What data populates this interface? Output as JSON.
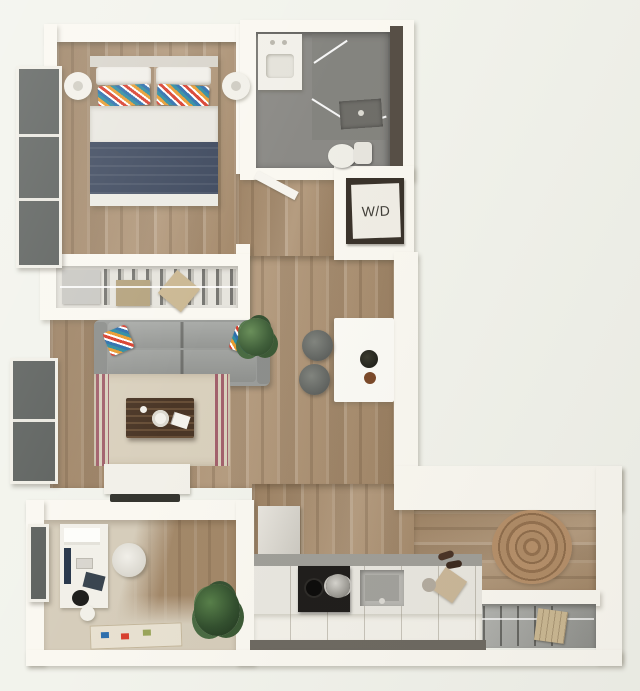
{
  "plan": {
    "wd_label": "W/D"
  },
  "colors": {
    "bg": "#f2f3ec",
    "wall": "#faf8f1",
    "wood": "#ab8f6f",
    "bath_floor": "#8b8a86",
    "sofa": "#9b9d9a",
    "navy": "#3f4a5f",
    "rug": "#d9d0bd",
    "rug_stripe": "#a2616c",
    "den_carpet": "#d6cdbb",
    "entry_rug": "#b08c67",
    "counter": "#e9e7e0",
    "cabinet": "#f3f1ea",
    "stove": "#201e1c",
    "steel": "#b9b8b3",
    "plant": "#41603b",
    "pillow_red": "#d8402f",
    "pillow_orange": "#e89b2f",
    "pillow_teal": "#2f8da0",
    "pillow_blue": "#2e6fad",
    "box_tan": "#cbb893",
    "closet_bg": "#e6e4dd",
    "window": "#5c605d",
    "tv": "#35352f",
    "text": "#413f39",
    "wd_frame": "#3a332b",
    "wood_dark_edge": "#574f46"
  }
}
